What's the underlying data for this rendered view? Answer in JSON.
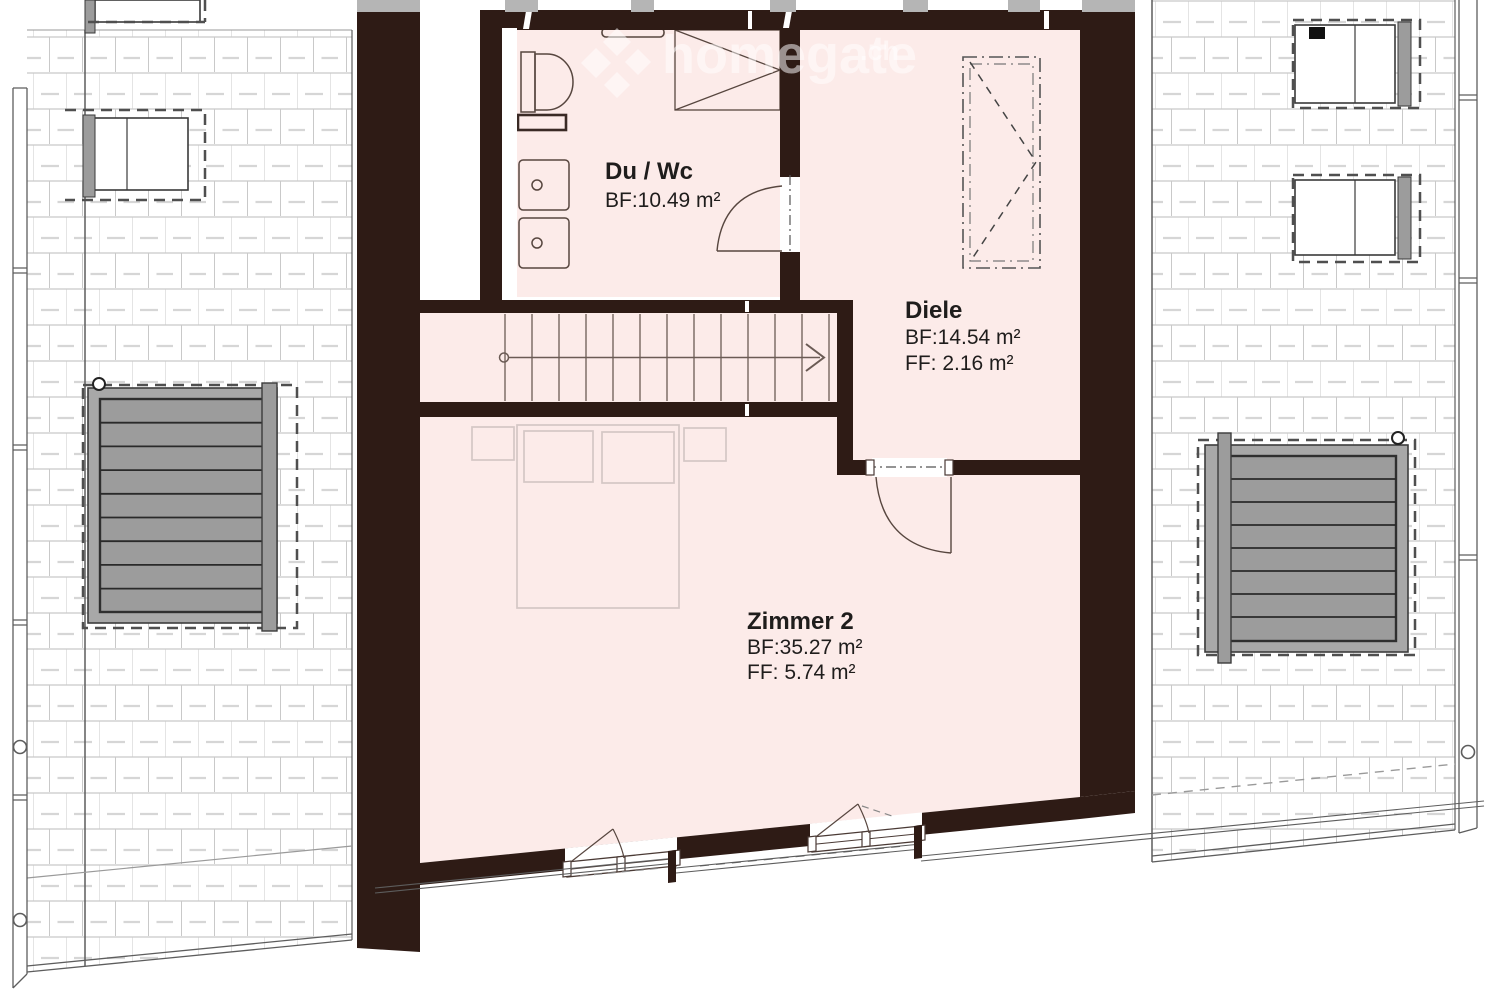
{
  "plan": {
    "watermark": {
      "text": "homegate",
      "tld": ".ch"
    },
    "rooms": {
      "duwc": {
        "name": "Du / Wc",
        "bf": "BF:10.49 m²"
      },
      "diele": {
        "name": "Diele",
        "bf": "BF:14.54 m²",
        "ff": "FF:  2.16 m²"
      },
      "zimmer2": {
        "name": "Zimmer 2",
        "bf": "BF:35.27 m²",
        "ff": "FF:  5.74 m²"
      }
    },
    "colors": {
      "room_fill": "#fcebe9",
      "wall": "#2e1b15",
      "tile_line": "#c9c9c9",
      "tile_dash": "#d6d6d6",
      "panel_gray": "#9c9c9c",
      "furniture_line": "#d4c7c5",
      "fixture_line": "#57463f",
      "watermark": "#ffffff"
    }
  }
}
